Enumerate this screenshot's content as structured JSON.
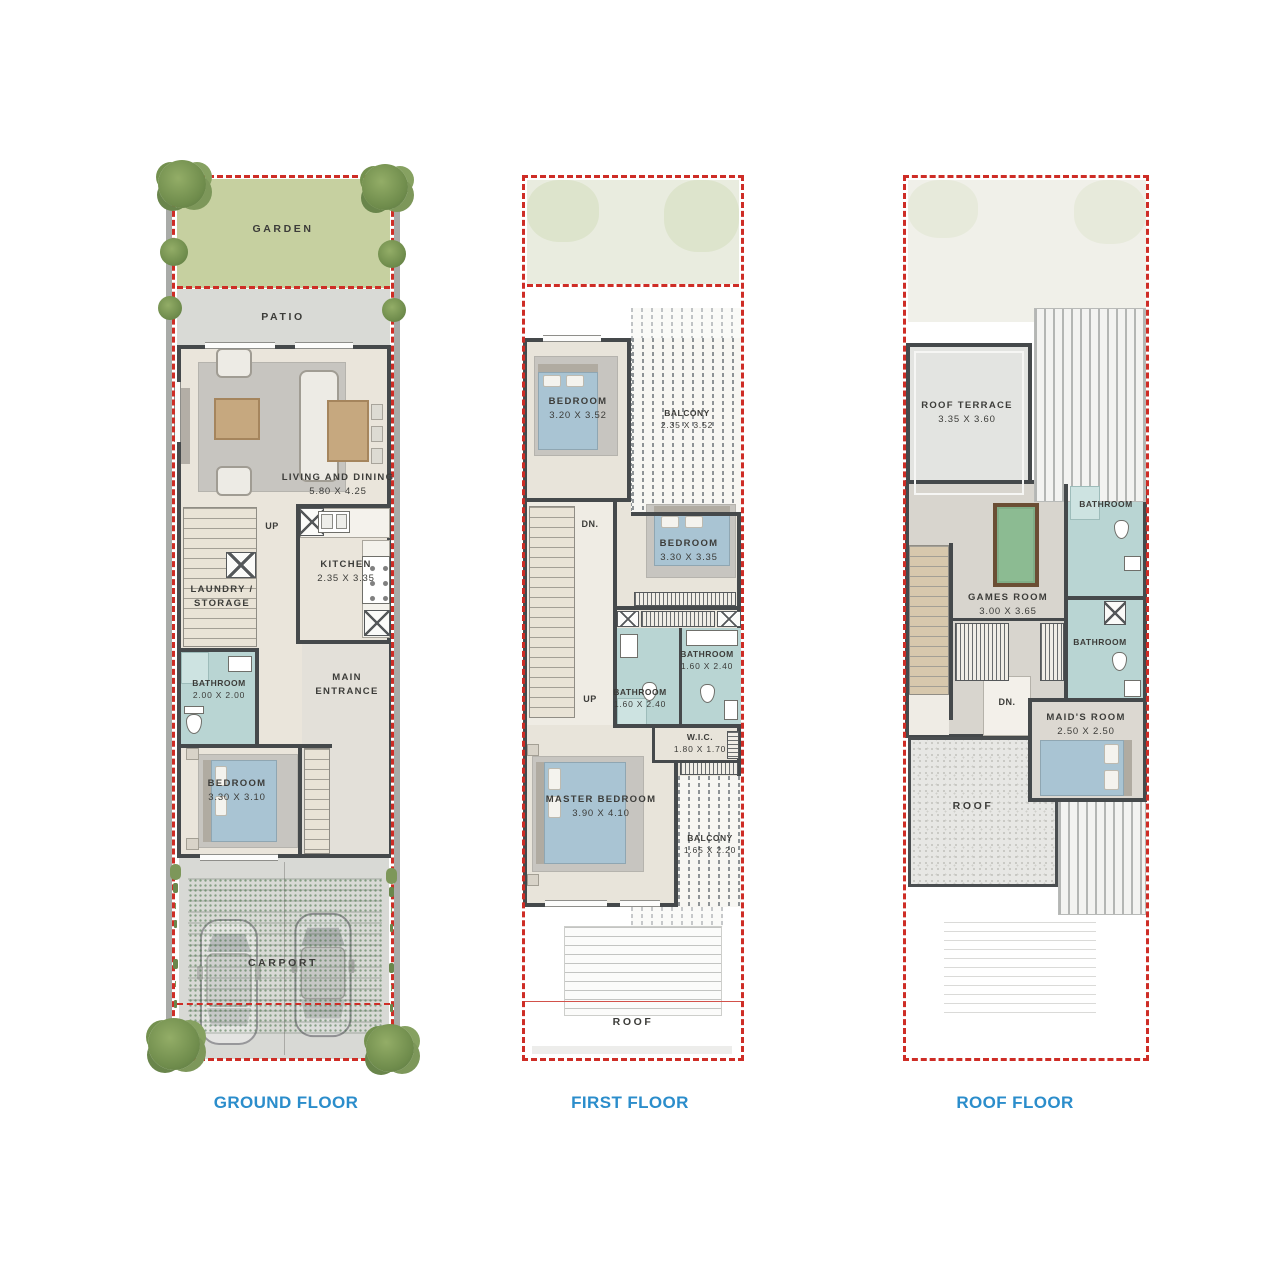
{
  "palette": {
    "plot_dash_red": "#ce2d26",
    "floor_title_blue": "#2b8dcb",
    "wall_dark": "#45494b",
    "garden_green": "#c6d0a0",
    "garden_faint": "#e9ecdf",
    "patio_grey": "#d9dad6",
    "interior_beige": "#eae5db",
    "bathroom_teal": "#b9d5d3",
    "bed_blue": "#a9c4d3",
    "wood_tan": "#c6a87f",
    "pool_table_green": "#8cbb92",
    "label_text": "#3c3c39"
  },
  "floors": [
    {
      "title": "GROUND FLOOR",
      "rooms": {
        "garden": {
          "label": "GARDEN"
        },
        "patio": {
          "label": "PATIO"
        },
        "living": {
          "label": "LIVING AND DINING",
          "dims": "5.80 X 4.25"
        },
        "stairs_up": {
          "label": "UP"
        },
        "kitchen": {
          "label": "KITCHEN",
          "dims": "2.35 X 3.35"
        },
        "laundry": {
          "line1": "LAUNDRY /",
          "line2": "STORAGE"
        },
        "bathroom": {
          "label": "BATHROOM",
          "dims": "2.00 X 2.00"
        },
        "entrance": {
          "line1": "MAIN",
          "line2": "ENTRANCE"
        },
        "bedroom": {
          "label": "BEDROOM",
          "dims": "3.30 X 3.10"
        },
        "carport": {
          "label": "CARPORT"
        }
      }
    },
    {
      "title": "FIRST FLOOR",
      "rooms": {
        "bedroom1": {
          "label": "BEDROOM",
          "dims": "3.20 X 3.52"
        },
        "balcony1": {
          "label": "BALCONY",
          "dims": "2.35 X 3.52"
        },
        "stairs_dn": {
          "label": "DN."
        },
        "stairs_up": {
          "label": "UP"
        },
        "bedroom2": {
          "label": "BEDROOM",
          "dims": "3.30 X 3.35"
        },
        "bathroom1": {
          "label": "BATHROOM",
          "dims": "1.60 X 2.40"
        },
        "bathroom2": {
          "label": "BATHROOM",
          "dims": "1.60 X 2.40"
        },
        "wic": {
          "label": "W.I.C.",
          "dims": "1.80 X 1.70"
        },
        "master": {
          "label": "MASTER BEDROOM",
          "dims": "3.90 X 4.10"
        },
        "balcony2": {
          "label": "BALCONY",
          "dims": "1.65 X 2.20"
        },
        "roof": {
          "label": "ROOF"
        }
      }
    },
    {
      "title": "ROOF FLOOR",
      "rooms": {
        "terrace": {
          "label": "ROOF TERRACE",
          "dims": "3.35 X 3.60"
        },
        "bathroom1": {
          "label": "BATHROOM"
        },
        "games": {
          "label": "GAMES ROOM",
          "dims": "3.00 X 3.65"
        },
        "bathroom2": {
          "label": "BATHROOM"
        },
        "stairs_dn": {
          "label": "DN."
        },
        "maid": {
          "label": "MAID'S ROOM",
          "dims": "2.50 X 2.50"
        },
        "roof": {
          "label": "ROOF"
        }
      }
    }
  ]
}
